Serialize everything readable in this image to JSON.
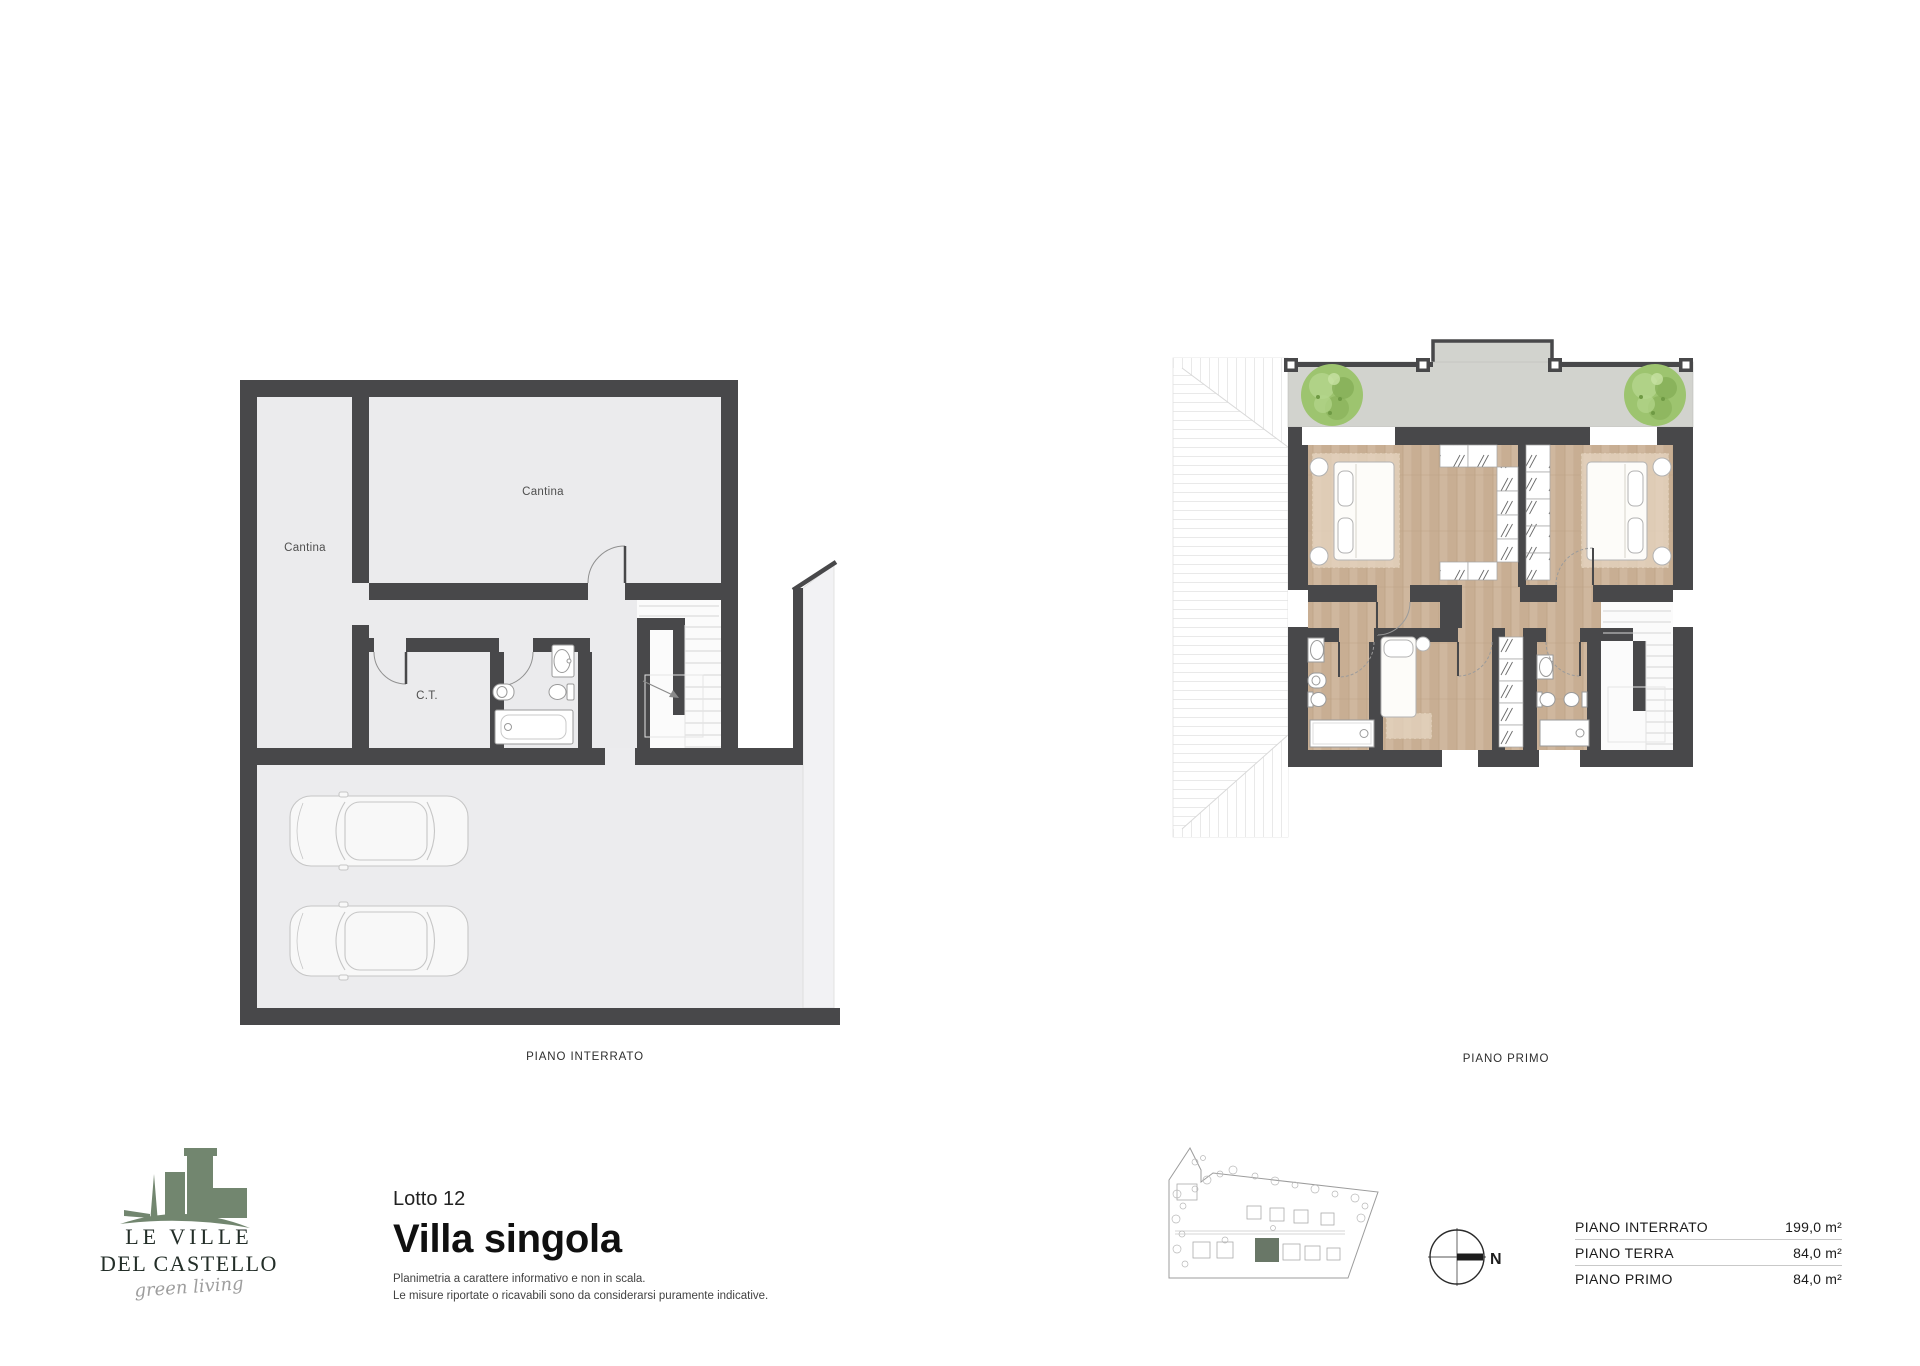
{
  "page": {
    "width": 1920,
    "height": 1366,
    "background": "#ffffff"
  },
  "plans": {
    "interrato": {
      "caption": "PIANO INTERRATO",
      "rooms": [
        {
          "label": "Cantina"
        },
        {
          "label": "Cantina"
        },
        {
          "label": "C.T."
        }
      ]
    },
    "primo": {
      "caption": "PIANO PRIMO"
    }
  },
  "branding": {
    "name_line1": "LE VILLE",
    "name_line2": "DEL CASTELLO",
    "tagline": "green living",
    "brand_color": "#72866f"
  },
  "lot": {
    "label": "Lotto 12",
    "title": "Villa singola",
    "disclaimer": [
      "Planimetria a carattere informativo e non in scala.",
      "Le misure riportate o ricavabili sono da considerarsi puramente indicative."
    ]
  },
  "compass": {
    "north_label": "N"
  },
  "area_table": {
    "rows": [
      {
        "label": "PIANO INTERRATO",
        "value": "199,0 m²"
      },
      {
        "label": "PIANO TERRA",
        "value": "84,0 m²"
      },
      {
        "label": "PIANO PRIMO",
        "value": "84,0 m²"
      }
    ]
  },
  "colors": {
    "wall": "#48484a",
    "floor_light": "#ebebed",
    "terrace": "#d2d3ce",
    "wood": "#cfb79e",
    "tree": "#9dc46f",
    "brand_green": "#72866f",
    "lot_highlight": "#5c6b5a"
  }
}
